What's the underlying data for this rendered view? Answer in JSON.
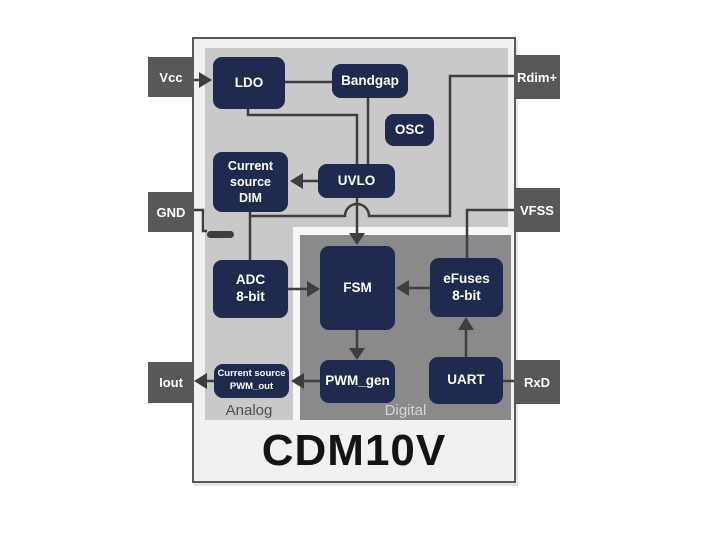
{
  "window": {
    "title": "CDM10V"
  },
  "regions": {
    "analog": "Analog",
    "digital": "Digital"
  },
  "pins": {
    "left": [
      {
        "id": "vcc",
        "label": "Vcc"
      },
      {
        "id": "gnd",
        "label": "GND"
      },
      {
        "id": "iout",
        "label": "Iout"
      }
    ],
    "right": [
      {
        "id": "rdim",
        "label": "Rdim+"
      },
      {
        "id": "vfss",
        "label": "VFSS"
      },
      {
        "id": "rxd",
        "label": "RxD"
      }
    ]
  },
  "blocks": {
    "ldo": {
      "label": "LDO"
    },
    "bandgap": {
      "label": "Bandgap"
    },
    "osc": {
      "label": "OSC"
    },
    "cs_dim": {
      "lines": [
        "Current",
        "source",
        "DIM"
      ]
    },
    "uvlo": {
      "label": "UVLO"
    },
    "adc": {
      "lines": [
        "ADC",
        "8-bit"
      ]
    },
    "fsm": {
      "label": "FSM"
    },
    "efuses": {
      "lines": [
        "eFuses",
        "8-bit"
      ]
    },
    "pwm_gen": {
      "label": "PWM_gen"
    },
    "cs_pwm": {
      "lines": [
        "Current source",
        "PWM_out"
      ]
    },
    "uart": {
      "label": "UART"
    }
  },
  "connections": [
    "Vcc -> LDO",
    "LDO - Bandgap",
    "LDO -> UVLO",
    "Bandgap -> UVLO",
    "UVLO -> Current source DIM",
    "UVLO -> FSM",
    "Rdim+ -> ADC 8-bit",
    "Current source DIM -> ADC 8-bit",
    "GND -> ground symbol",
    "VFSS -> eFuses 8-bit",
    "ADC 8-bit -> FSM",
    "eFuses 8-bit -> FSM",
    "FSM -> PWM_gen",
    "PWM_gen -> Current source PWM_out",
    "Current source PWM_out -> Iout",
    "UART -> eFuses 8-bit",
    "RxD - UART"
  ],
  "colors": {
    "block_navy": "#1f2a4e",
    "analog_gray": "#c9c9c9",
    "digital_gray": "#8a8a8a",
    "digital_border_white": "#f7f7f7",
    "pin_gray": "#58585a",
    "chip_bg": "#f1f1f1",
    "chip_border": "#59595b",
    "wire": "#3e3e40"
  }
}
